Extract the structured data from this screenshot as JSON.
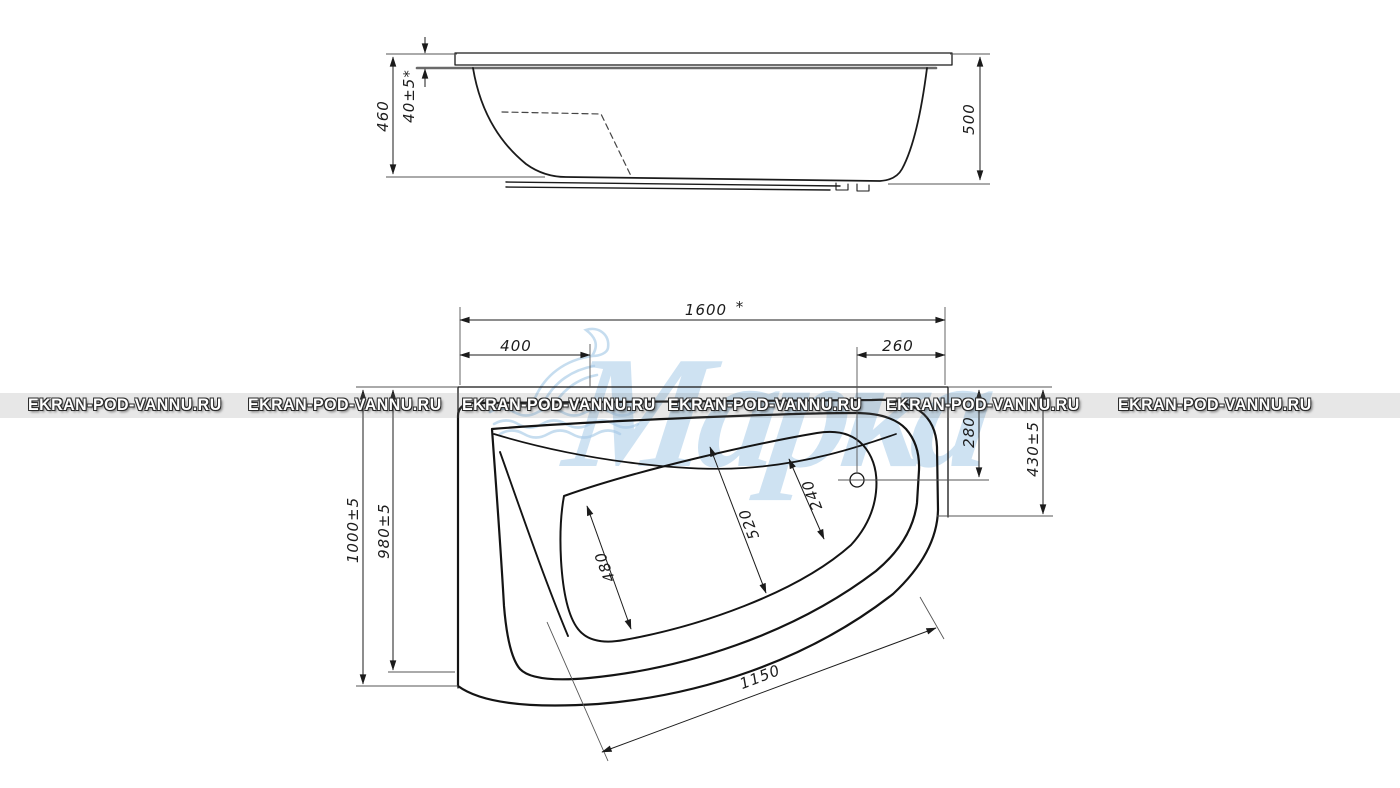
{
  "watermark": {
    "site_text": "EKRAN-POD-VANNU.RU",
    "brand_text": "Марка"
  },
  "side_view": {
    "dims": {
      "height_to_shell_bottom": "460",
      "rim_thickness": "40±5*",
      "overall_height": "500"
    }
  },
  "plan_view": {
    "dims": {
      "overall_length": "1600",
      "overall_length_note": "*",
      "head_edge_offset": "400",
      "drain_edge_offset": "260",
      "drain_axis_offset": "280",
      "right_side_width": "430±5",
      "overall_width": "1000±5",
      "inner_width": "980±5",
      "foot_inner_width": "480",
      "middle_inner_width": "520",
      "drain_inner_width": "240",
      "front_edge_length": "1150"
    }
  },
  "colors": {
    "line": "#1b1b1b",
    "brand_blue": "#9ec6e6",
    "watermark_text": "#ffffff"
  }
}
